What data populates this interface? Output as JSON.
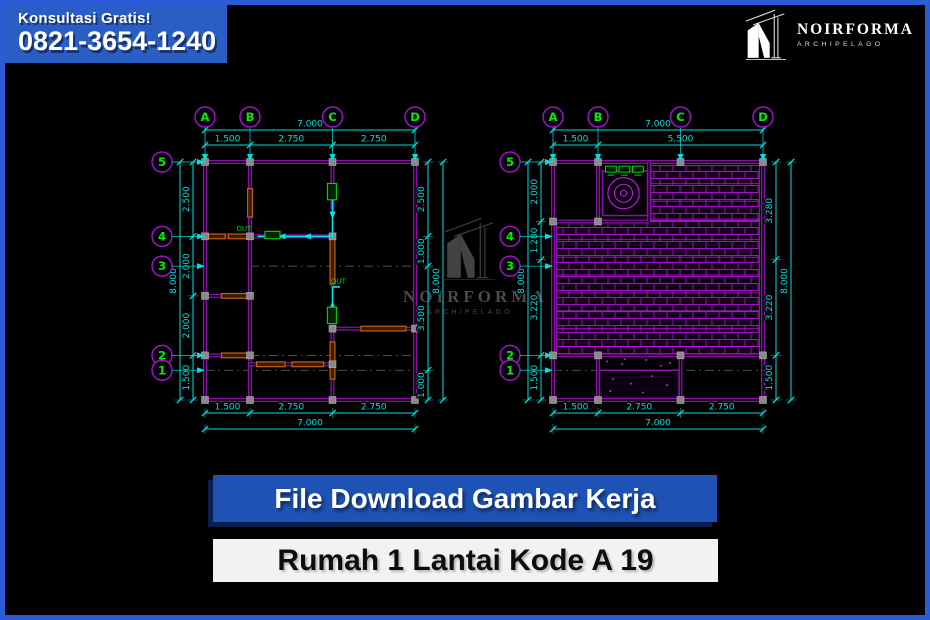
{
  "badge": {
    "line1": "Konsultasi Gratis!",
    "line2": "0821-3654-1240"
  },
  "brand": {
    "name": "NOIRFORMA",
    "sub": "ARCHIPELAGO"
  },
  "watermark": {
    "name": "NOIRFORMA",
    "sub": "ARCHIPELAGO"
  },
  "banners": {
    "primary": "File Download Gambar Kerja",
    "secondary": "Rumah 1 Lantai Kode A 19"
  },
  "colors": {
    "border_blue": "#2b5cd6",
    "badge_blue": "#2a5ec4",
    "banner_blue": "#1e52b4",
    "wall": "#8c10a8",
    "dim": "#00dede",
    "grid_text": "#00ee00",
    "bubble": "#a014c8",
    "accent_stroke": "#c06018",
    "accent_fill": "#3a1c06",
    "pipe": "#00e6e6",
    "pipe_label": "#00d800",
    "hatch_line": "#a012c8",
    "hatch_bright": "#c818e8",
    "hatch_bg": "#140018",
    "marker": "#8a8a8a",
    "dash": "#8a8a8a",
    "watermark_grey": "#4f4f4f"
  },
  "drawing": {
    "grid_cols": {
      "labels": [
        "A",
        "B",
        "C",
        "D"
      ],
      "m": [
        0,
        1.5,
        4.25,
        7
      ]
    },
    "grid_rows": {
      "labels": [
        "5",
        "4",
        "3",
        "2",
        "1"
      ],
      "m": [
        0,
        2.5,
        3.5,
        6.5,
        7.0
      ]
    },
    "plans": [
      {
        "name": "floor-plan",
        "dims": {
          "top_total": "7.000",
          "top_segments": {
            "lens": [
              1.5,
              2.75,
              2.75
            ],
            "labels": [
              "1.500",
              "2.750",
              "2.750"
            ]
          },
          "bottom_segments": {
            "lens": [
              1.5,
              2.75,
              2.75
            ],
            "labels": [
              "1.500",
              "2.750",
              "2.750"
            ]
          },
          "bottom_total": "7.000",
          "left_total": "8.000",
          "left_segments": {
            "lens": [
              2.5,
              2.0,
              2.0,
              1.5
            ],
            "labels": [
              "2.500",
              "2.000",
              "2.000",
              "1.500"
            ]
          },
          "right_segments": {
            "lens": [
              2.5,
              1.0,
              3.5,
              1.0
            ],
            "labels": [
              "2.500",
              "1.000",
              "3.500",
              "1.000"
            ]
          },
          "right_total": "8.000"
        },
        "walls": [
          [
            0,
            0,
            7,
            0
          ],
          [
            7,
            0,
            7,
            8
          ],
          [
            7,
            8,
            0,
            8
          ],
          [
            0,
            8,
            0,
            0
          ],
          [
            1.5,
            0,
            1.5,
            8
          ],
          [
            4.25,
            0,
            4.25,
            1.6
          ],
          [
            4.25,
            2.5,
            4.25,
            4.2
          ],
          [
            4.25,
            5.6,
            4.25,
            8
          ],
          [
            0,
            2.5,
            4.25,
            2.5
          ],
          [
            0,
            4.5,
            1.5,
            4.5
          ],
          [
            4.25,
            5.6,
            7,
            5.6
          ],
          [
            0,
            6.5,
            1.5,
            6.5
          ],
          [
            1.5,
            6.8,
            4.25,
            6.8
          ]
        ],
        "accents": [
          [
            0.12,
            2.42,
            0.55,
            0.16
          ],
          [
            0.78,
            2.42,
            0.62,
            0.16
          ],
          [
            1.42,
            0.9,
            0.16,
            0.95
          ],
          [
            0.55,
            4.42,
            0.9,
            0.16
          ],
          [
            0.55,
            6.42,
            0.9,
            0.16
          ],
          [
            5.2,
            5.52,
            1.5,
            0.16
          ],
          [
            4.17,
            2.6,
            0.16,
            1.5
          ],
          [
            4.17,
            6.05,
            0.16,
            1.25
          ],
          [
            1.72,
            6.72,
            0.95,
            0.16
          ],
          [
            2.9,
            6.72,
            1.05,
            0.16
          ]
        ],
        "dashes": [
          [
            1.5,
            3.5,
            7,
            3.5
          ],
          [
            1.5,
            6.5,
            7,
            6.5
          ],
          [
            0,
            7.0,
            7,
            7.0
          ],
          [
            4.25,
            1.6,
            4.25,
            2.5
          ],
          [
            4.25,
            4.2,
            4.25,
            5.6
          ]
        ],
        "markers": [
          [
            0,
            0
          ],
          [
            1.5,
            0
          ],
          [
            4.25,
            0
          ],
          [
            7,
            0
          ],
          [
            0,
            2.5
          ],
          [
            1.5,
            2.5
          ],
          [
            4.25,
            2.5
          ],
          [
            0,
            4.5
          ],
          [
            1.5,
            4.5
          ],
          [
            0,
            6.5
          ],
          [
            1.5,
            6.5
          ],
          [
            4.25,
            5.6
          ],
          [
            7,
            5.6
          ],
          [
            0,
            8
          ],
          [
            1.5,
            8
          ],
          [
            4.25,
            8
          ],
          [
            7,
            8
          ],
          [
            4.25,
            6.8
          ]
        ],
        "pipes": [
          {
            "pts": [
              [
                4.25,
                1.0
              ],
              [
                4.25,
                2.5
              ],
              [
                1.75,
                2.5
              ]
            ],
            "arrows": [
              [
                4.25,
                1.8,
                180
              ],
              [
                3.4,
                2.5,
                270
              ],
              [
                2.55,
                2.5,
                270
              ]
            ],
            "label": "OUT",
            "label_at": [
              1.3,
              2.32
            ],
            "units": [
              [
                2.0,
                2.33,
                0.5,
                0.25
              ],
              [
                4.08,
                0.72,
                0.3,
                0.55
              ]
            ]
          },
          {
            "pts": [
              [
                4.25,
                5.45
              ],
              [
                4.25,
                4.2
              ],
              [
                4.5,
                4.2
              ]
            ],
            "arrows": [
              [
                4.25,
                4.8,
                0
              ]
            ],
            "label": "OUT",
            "label_at": [
              4.45,
              4.08
            ],
            "units": [
              [
                4.08,
                4.88,
                0.3,
                0.55
              ]
            ]
          }
        ]
      },
      {
        "name": "roof-plan",
        "dims": {
          "top_total": "7.000",
          "top_segments": {
            "lens": [
              1.5,
              5.5
            ],
            "labels": [
              "1.500",
              "5.500"
            ]
          },
          "bottom_segments": {
            "lens": [
              1.5,
              2.75,
              2.75
            ],
            "labels": [
              "1.500",
              "2.750",
              "2.750"
            ]
          },
          "bottom_total": "7.000",
          "left_total": "8.000",
          "left_segments": {
            "lens": [
              2.0,
              1.28,
              3.22,
              1.5
            ],
            "labels": [
              "2.000",
              "1.280",
              "3.220",
              "1.500"
            ]
          },
          "right_segments": {
            "lens": [
              3.28,
              3.22,
              1.5
            ],
            "labels": [
              "3.280",
              "3.220",
              "1.500"
            ]
          },
          "right_total": "8.000"
        },
        "walls": [
          [
            0,
            0,
            7,
            0
          ],
          [
            7,
            0,
            7,
            8
          ],
          [
            7,
            8,
            0,
            8
          ],
          [
            0,
            8,
            0,
            0
          ],
          [
            1.5,
            0,
            1.5,
            2.0
          ],
          [
            0,
            2.0,
            3.2,
            2.0
          ],
          [
            3.2,
            0,
            3.2,
            2.0
          ],
          [
            0,
            6.5,
            7,
            6.5
          ],
          [
            1.5,
            6.5,
            1.5,
            8
          ],
          [
            4.25,
            6.5,
            4.25,
            8
          ]
        ],
        "accents": [],
        "dashes": [
          [
            0,
            7.0,
            7,
            7.0
          ]
        ],
        "markers": [
          [
            0,
            0
          ],
          [
            1.5,
            0
          ],
          [
            4.25,
            0
          ],
          [
            7,
            0
          ],
          [
            0,
            2
          ],
          [
            1.5,
            2
          ],
          [
            0,
            6.5
          ],
          [
            1.5,
            6.5
          ],
          [
            4.25,
            6.5
          ],
          [
            7,
            6.5
          ],
          [
            0,
            8
          ],
          [
            1.5,
            8
          ],
          [
            4.25,
            8
          ],
          [
            7,
            8
          ]
        ],
        "pipes": [],
        "hatch": [
          [
            3.25,
            0.12,
            3.63,
            1.88
          ],
          [
            0.12,
            2.0,
            6.76,
            4.5
          ]
        ],
        "fan": {
          "box": [
            1.65,
            0.3,
            1.5,
            1.5
          ],
          "cx": 2.35,
          "cy": 1.05,
          "r": [
            0.52,
            0.3,
            0.1
          ]
        },
        "tags": [
          [
            1.75,
            0.14
          ],
          [
            2.2,
            0.14
          ],
          [
            2.65,
            0.14
          ]
        ],
        "porch": [
          1.55,
          7.0,
          2.65,
          0.95
        ],
        "speckles": [
          [
            1.8,
            6.7
          ],
          [
            2.3,
            6.8
          ],
          [
            3.1,
            6.65
          ],
          [
            3.9,
            6.75
          ],
          [
            2.0,
            7.3
          ],
          [
            2.6,
            7.45
          ],
          [
            3.3,
            7.2
          ],
          [
            3.8,
            7.5
          ],
          [
            1.9,
            7.7
          ],
          [
            3.0,
            7.75
          ],
          [
            2.4,
            6.63
          ],
          [
            3.6,
            6.85
          ]
        ]
      }
    ]
  }
}
